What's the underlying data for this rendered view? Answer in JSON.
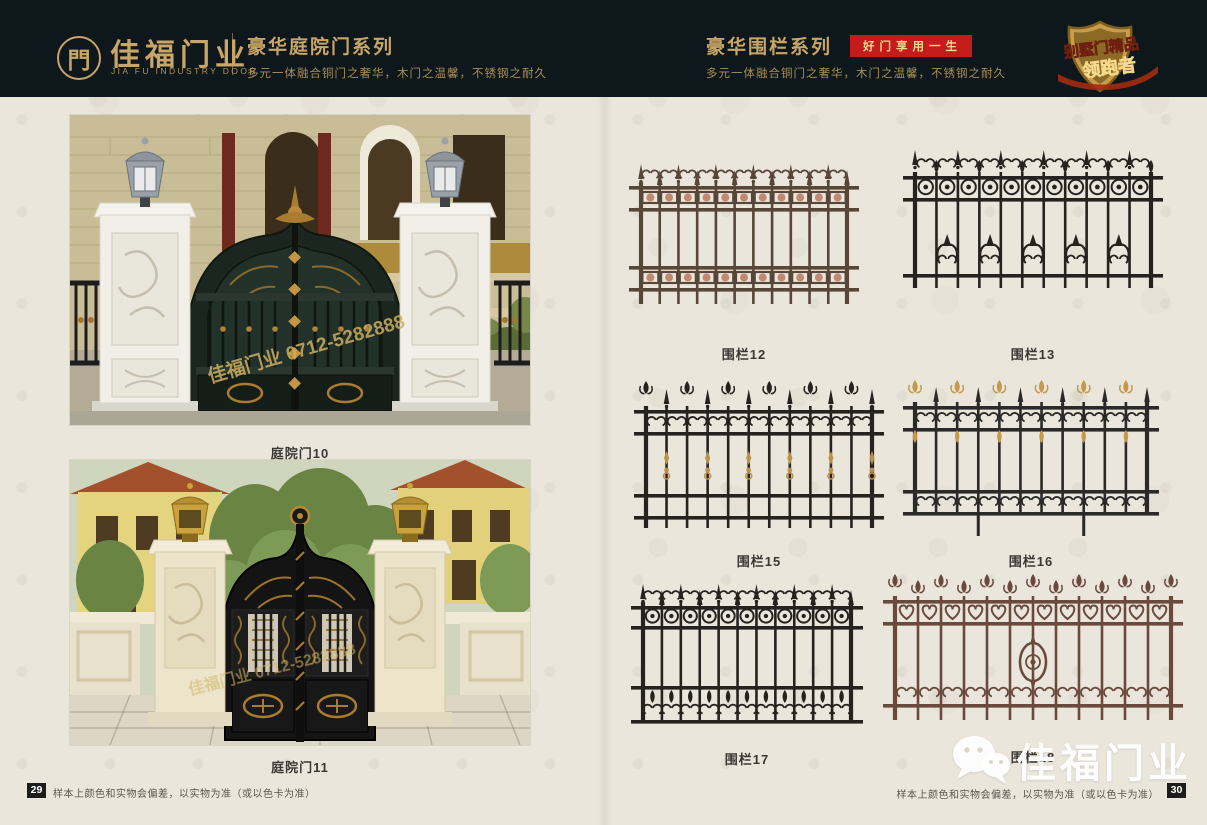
{
  "header": {
    "logo": {
      "symbol": "門",
      "brand": "佳福门业",
      "brand_en": "JIA FU INDUSTRY DOOR"
    },
    "left_series": {
      "title": "豪华庭院门系列",
      "subtitle": "多元一体融合铜门之奢华，木门之温馨，不锈钢之耐久"
    },
    "right_series": {
      "title": "豪华围栏系列",
      "badge": "好门享用一生",
      "subtitle": "多元一体融合铜门之奢华，木门之温馨，不锈钢之耐久"
    },
    "emblem": {
      "line1": "别墅门精品",
      "line2": "领跑者"
    }
  },
  "left_page": {
    "photo_watermark": "佳福门业 0712-5282888",
    "products": [
      {
        "caption": "庭院门10"
      },
      {
        "caption": "庭院门11"
      }
    ],
    "footer": {
      "page_number": "29",
      "note": "样本上颜色和实物会偏差，以实物为准（或以色卡为准）"
    }
  },
  "right_page": {
    "products": [
      {
        "caption": "围栏12"
      },
      {
        "caption": "围栏13"
      },
      {
        "caption": "围栏15"
      },
      {
        "caption": "围栏16"
      },
      {
        "caption": "围栏17"
      },
      {
        "caption": "围栏18"
      }
    ],
    "watermark": "佳福门业",
    "footer": {
      "note": "样本上颜色和实物会偏差，以实物为准（或以色卡为准）",
      "page_number": "30"
    }
  },
  "colors": {
    "header_bg": "#0d171c",
    "gold": "#c9a566",
    "badge_red": "#c41b1b",
    "page_bg": "#ebe6dc",
    "fence_black": "#26231f",
    "fence_copper": "#584639",
    "fence_copper_red": "#6a4a3d"
  }
}
